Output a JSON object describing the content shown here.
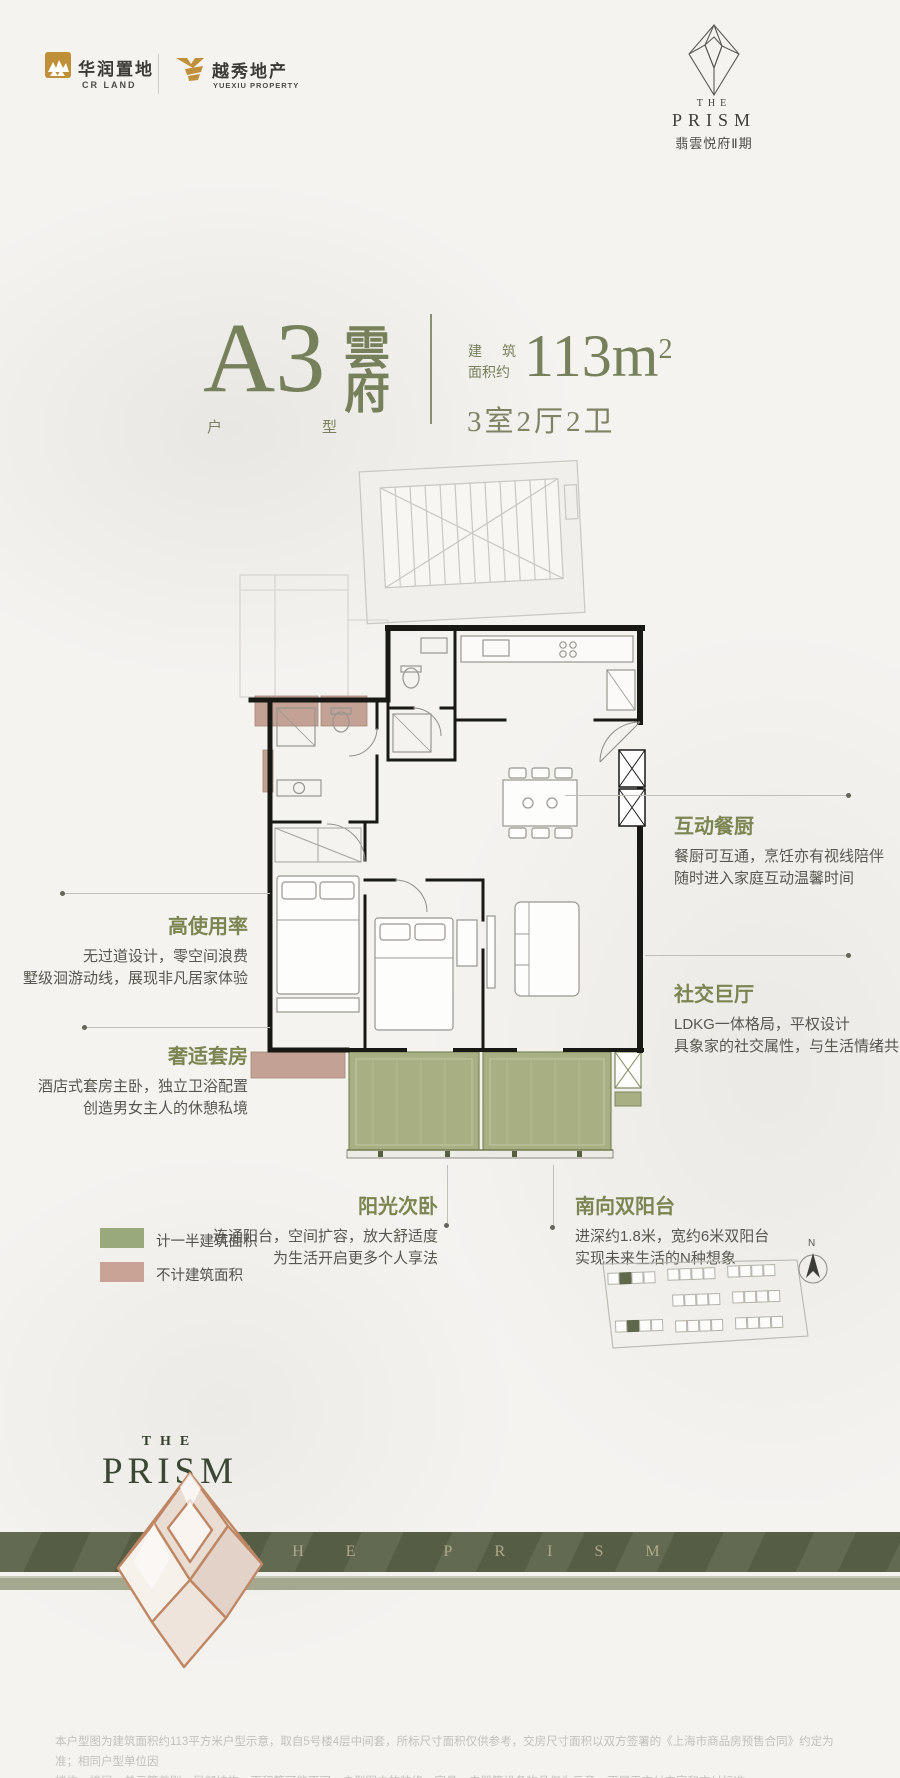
{
  "brand": {
    "crland_cn": "华润置地",
    "crland_en": "CR LAND",
    "yuexiu_cn": "越秀地产",
    "yuexiu_en": "YUEXIU PROPERTY"
  },
  "project_logo": {
    "the": "THE",
    "prism": "PRISM",
    "project": "翡雲悦府Ⅱ期"
  },
  "headline": {
    "unit_code": "A3",
    "unit_char1": "雲",
    "unit_char2": "府",
    "type_label": "户型",
    "area_prefix1": "建筑",
    "area_prefix2": "面积约",
    "area_number": "113m",
    "area_sup": "2",
    "rooms": "3室2厅2卫"
  },
  "annotations": [
    {
      "title": "互动餐厨",
      "line1": "餐厨可互通，烹饪亦有视线陪伴",
      "line2": "随时进入家庭互动温馨时间"
    },
    {
      "title": "高使用率",
      "line1": "无过道设计，零空间浪费",
      "line2": "墅级洄游动线，展现非凡居家体验"
    },
    {
      "title": "奢适套房",
      "line1": "酒店式套房主卧，独立卫浴配置",
      "line2": "创造男女主人的休憩私境"
    },
    {
      "title": "社交巨厅",
      "line1": "LDKG一体格局，平权设计",
      "line2": "具象家的社交属性，与生活情绪共鸣"
    },
    {
      "title": "阳光次卧",
      "line1": "连通阳台，空间扩容，放大舒适度",
      "line2": "为生活开启更多个人享法"
    },
    {
      "title": "南向双阳台",
      "line1": "进深约1.8米，宽约6米双阳台",
      "line2": "实现未来生活的N种想象"
    }
  ],
  "legend": {
    "items": [
      {
        "label": "计一半建筑面积",
        "color": "#9AA97B"
      },
      {
        "label": "不计建筑面积",
        "color": "#C8A396"
      }
    ]
  },
  "sitemap": {
    "north_label": "N"
  },
  "bottom_logo": {
    "the": "THE",
    "prism": "PRISM"
  },
  "band": {
    "text": "THE PRISM"
  },
  "footer": {
    "line1": "本户型图为建筑面积约113平方米户型示意，取自5号楼4层中间套，所标尺寸面积仅供参考，交房尺寸面积以双方签署的《上海市商品房预售合同》约定为准；相同户型单位因",
    "line2": "楼栋、楼层、单元等差别，局部结构、面积等可能不同，户型图中的装修、家具、电器等设备物品仅为示意，不属于交付内容和交付标准。"
  },
  "colors": {
    "background": "#F4F3F0",
    "accent_olive": "#76805A",
    "annotation_title_green": "#7B8551",
    "balcony_fill_green": "#A8B083",
    "non_area_tan": "#C3A194",
    "band_dark_olive": "#5A6349",
    "band_light_olive": "#A4A88E",
    "logo_gold": "#C08F3A",
    "wall_black": "#181815",
    "body_text_gray": "#58574F",
    "footer_gray": "#C3C1BC"
  }
}
